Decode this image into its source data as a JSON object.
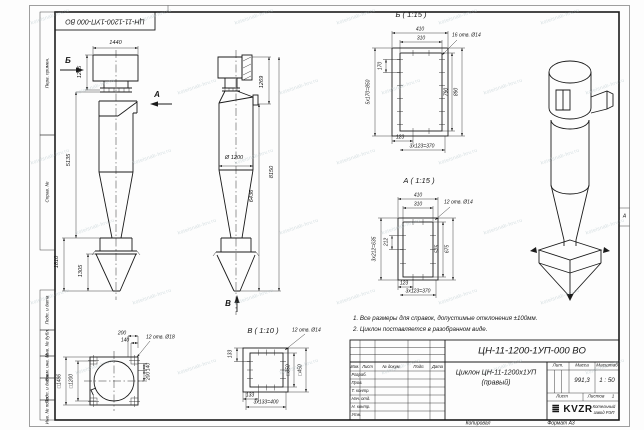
{
  "stamp": {
    "doc_number": "ЦН-11-1200-1УП-000 ВО"
  },
  "sheet": {
    "zone_letter": "А",
    "copied_label": "Копировал",
    "format_label": "Формат А3"
  },
  "watermark": {
    "text": "kotelsnab-hrv.ru"
  },
  "margin_labels": {
    "perv_primen": "Перв. примен.",
    "sprav_no": "Справ. №",
    "podp_data_1": "Подп. и дата",
    "inv_dubl": "Инв. № дубл.",
    "vzam_inv": "Взам. инв. №",
    "podp_data_2": "Подп. и дата",
    "inv_podl": "Инв. № подл."
  },
  "notes": {
    "line1": "1. Все размеры для справок, допустимые отклонения ±100мм.",
    "line2": "2. Циклон поставляется в разобранном виде."
  },
  "title_block": {
    "doc_number": "ЦН-11-1200-1УП-000 ВО",
    "name_line1": "Циклон ЦН-11-1200х1УП",
    "name_line2": "(правый)",
    "header": {
      "izm": "Изм.",
      "list": "Лист",
      "doc": "№ докум.",
      "podp": "Подп.",
      "data": "Дата"
    },
    "rows": {
      "razrab": "Разраб.",
      "prov": "Пров.",
      "t_kontr": "Т. контр.",
      "nach_otd": "Нач. отд.",
      "n_kontr": "Н. контр.",
      "utv": "Утв."
    },
    "lit_label": "Лит.",
    "massa_label": "Масса",
    "masshtab_label": "Масштаб",
    "massa_value": "991,3",
    "masshtab_value": "1 : 50",
    "list_label": "Лист",
    "listov_label": "Листов",
    "listov_value": "1",
    "logo_bars": "≣",
    "logo_text": "KVZR",
    "company_line1": "Котельный",
    "company_line2": "завод РЭП"
  },
  "views": {
    "front": {
      "dim_width": "1440",
      "dim_h1": "1205",
      "dim_h2": "5135",
      "dim_h3": "1810",
      "dim_h4": "1305",
      "label_b": "Б",
      "label_a": "А"
    },
    "middle": {
      "dim_h1": "1269",
      "dim_total": "8150",
      "dim_h2": "6436",
      "dim_dia": "Ø 1200",
      "label_v": "В"
    },
    "view_b": {
      "title": "Б ( 1:15 )",
      "holes": "16 отв. Ø14",
      "dim_410": "410",
      "dim_310": "310",
      "dim_170": "170",
      "dim_850": "5х170=850",
      "dim_790": "790",
      "dim_890": "890",
      "dim_123": "123",
      "dim_370": "3х123=370"
    },
    "view_a": {
      "title": "А ( 1:15 )",
      "holes": "12 отв. Ø14",
      "dim_410": "410",
      "dim_310": "310",
      "dim_212": "212",
      "dim_635": "3х212=635",
      "dim_575": "575",
      "dim_675": "675",
      "dim_123": "123",
      "dim_370": "3х123=370"
    },
    "view_v": {
      "title": "В ( 1:10 )",
      "holes": "12 отв. Ø14",
      "dim_133l": "133",
      "dim_350": "□350",
      "dim_450": "□450",
      "dim_133b": "133",
      "dim_400": "3х133=400"
    },
    "top_view": {
      "holes": "12 отв. Ø18",
      "dim_200t": "200",
      "dim_140t": "140",
      "dim_140r": "140",
      "dim_200r": "200",
      "dim_1486": "□1486",
      "dim_1200": "□1200"
    }
  }
}
